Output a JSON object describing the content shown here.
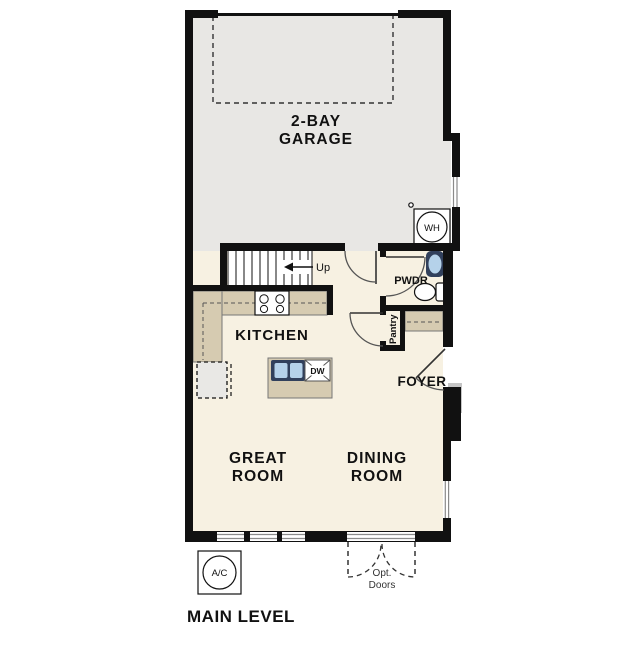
{
  "title": "MAIN LEVEL",
  "colors": {
    "wall": "#111111",
    "garage_floor": "#e8e7e4",
    "interior_floor": "#f7f1e2",
    "counter": "#d6cbb1",
    "sink_basin": "#b5d2ea",
    "sink_outline": "#31405c",
    "window": "#8a8a8a",
    "stoop": "#c6c6c6"
  },
  "rooms": {
    "garage": {
      "line1": "2-BAY",
      "line2": "GARAGE"
    },
    "kitchen": {
      "label": "KITCHEN"
    },
    "great_room": {
      "line1": "GREAT",
      "line2": "ROOM"
    },
    "dining_room": {
      "line1": "DINING",
      "line2": "ROOM"
    },
    "foyer": {
      "label": "FOYER"
    },
    "powder_room": {
      "label": "PWDR"
    },
    "pantry": {
      "label": "Pantry"
    }
  },
  "annotations": {
    "stairs": "Up",
    "water_heater": "WH",
    "dishwasher": "DW",
    "ac_unit": "A/C",
    "optional_doors_line1": "Opt.",
    "optional_doors_line2": "Doors"
  }
}
